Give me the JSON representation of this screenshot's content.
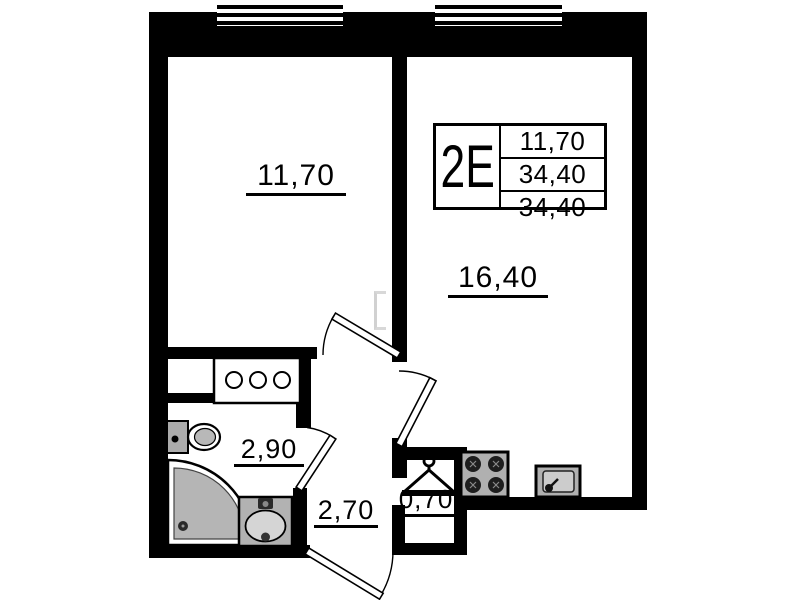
{
  "plan": {
    "unit_type_label": "2Е",
    "info_table": {
      "rows": [
        "11,70",
        "34,40",
        "34,40"
      ]
    },
    "rooms": {
      "bedroom": {
        "area": "11,70"
      },
      "kitchen_living": {
        "area": "16,40"
      },
      "bathroom": {
        "area": "2,90"
      },
      "hallway": {
        "area": "2,70"
      },
      "closet": {
        "area": "0,70"
      }
    },
    "icons": {
      "hanger": "hanger-icon",
      "stove": "stove-icon",
      "kitchen_sink": "kitchen-sink-icon",
      "washbasin": "washbasin-icon",
      "toilet": "toilet-icon",
      "shower": "shower-tray-icon",
      "window": "window-icon",
      "door": "door-swing-icon",
      "cabinet": "cabinet-icon"
    },
    "colors": {
      "wall": "#000000",
      "background": "#ffffff",
      "fixture_fill": "#b5b5b5",
      "fixture_light": "#d5d5d5"
    }
  }
}
